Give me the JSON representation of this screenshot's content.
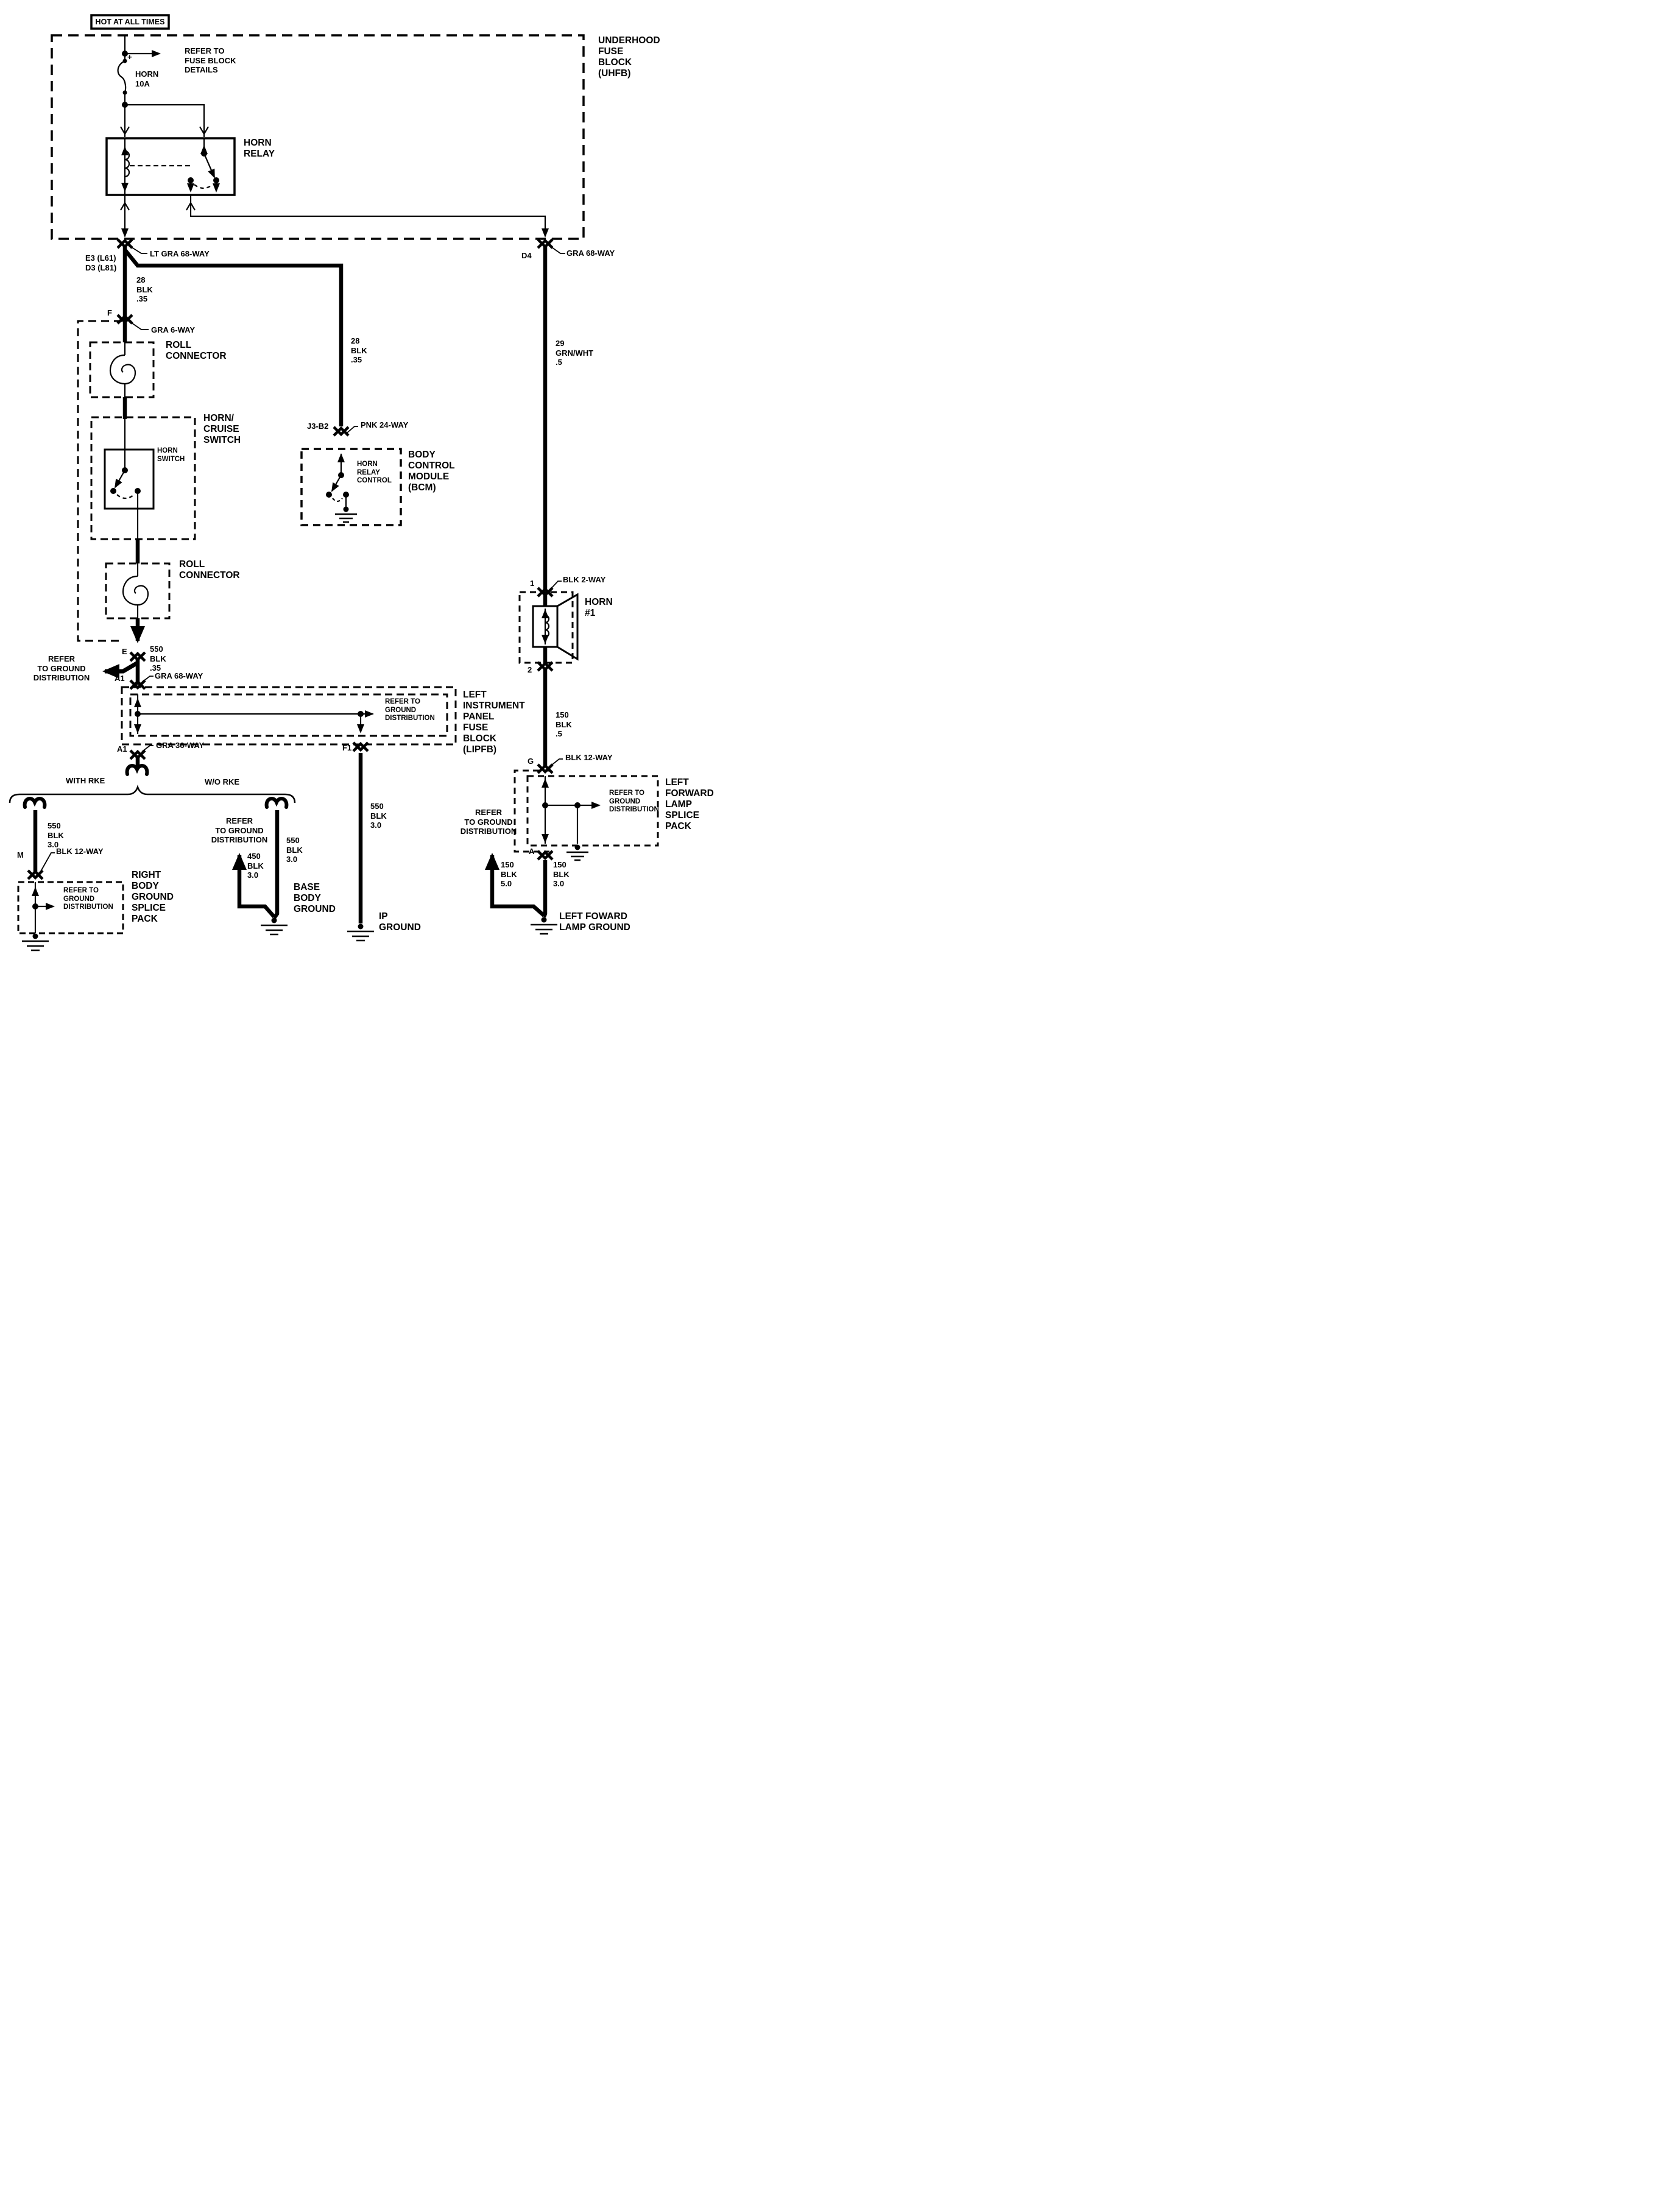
{
  "page": {
    "background": "#ffffff",
    "ink": "#000000"
  },
  "header": {
    "hot_tag": "HOT AT ALL TIMES"
  },
  "uhfb": {
    "refer_fuse": "REFER TO\nFUSE BLOCK\nDETAILS",
    "fuse_plus": "+",
    "fuse_name": "HORN\n10A",
    "title": "UNDERHOOD\nFUSE\nBLOCK\n(UHFB)",
    "relay_name": "HORN\nRELAY",
    "pin_left": "E3 (L61)\nD3 (L81)",
    "conn_left": "LT GRA 68-WAY",
    "pin_right": "D4",
    "conn_right": "GRA 68-WAY"
  },
  "left_run": {
    "wire_top": "28\nBLK\n.35",
    "pin_f": "F",
    "conn_f": "GRA 6-WAY",
    "roll_top": "ROLL\nCONNECTOR",
    "switch_title": "HORN/\nCRUISE\nSWITCH",
    "switch_inner": "HORN\nSWITCH",
    "roll_bottom": "ROLL\nCONNECTOR",
    "refer_ground": "REFER\nTO GROUND\nDISTRIBUTION",
    "pin_e": "E",
    "wire_e": "550\nBLK\n.35",
    "pin_a1": "A1",
    "conn_a1": "GRA 68-WAY"
  },
  "bcm": {
    "pin": "J3-B2",
    "conn": "PNK 24-WAY",
    "wire": "28\nBLK\n.35",
    "control": "HORN\nRELAY\nCONTROL",
    "title": "BODY\nCONTROL\nMODULE\n(BCM)"
  },
  "lipfb": {
    "refer_ground": "REFER TO\nGROUND\nDISTRIBUTION",
    "title": "LEFT\nINSTRUMENT\nPANEL\nFUSE\nBLOCK\n(LIPFB)",
    "pin_a1": "A1",
    "conn_a1": "GRA 36-WAY",
    "pin_f1": "F1"
  },
  "branches": {
    "with_rke": "WITH RKE",
    "without_rke": "W/O RKE"
  },
  "rbgsp": {
    "wire": "550\nBLK\n3.0",
    "pin_m": "M",
    "conn_m": "BLK 12-WAY",
    "refer_ground": "REFER TO\nGROUND\nDISTRIBUTION",
    "title": "RIGHT\nBODY\nGROUND\nSPLICE\nPACK"
  },
  "base_ground": {
    "refer_ground": "REFER\nTO GROUND\nDISTRIBUTION",
    "wire_branch": "450\nBLK\n3.0",
    "wire_main": "550\nBLK\n3.0",
    "title": "BASE\nBODY\nGROUND"
  },
  "ip_ground": {
    "wire": "550\nBLK\n3.0",
    "title": "IP\nGROUND"
  },
  "horn": {
    "wire_top": "29\nGRN/WHT\n.5",
    "pin_1": "1",
    "conn": "BLK 2-WAY",
    "title": "HORN\n#1",
    "pin_2": "2",
    "wire_bottom": "150\nBLK\n.5"
  },
  "lflsp": {
    "pin_g": "G",
    "conn_g": "BLK 12-WAY",
    "refer_ground": "REFER TO\nGROUND\nDISTRIBUTION",
    "title": "LEFT\nFORWARD\nLAMP\nSPLICE\nPACK",
    "refer_ground_left": "REFER\nTO GROUND\nDISTRIBUTION",
    "pin_a": "A",
    "wire_left": "150\nBLK\n5.0",
    "wire_right": "150\nBLK\n3.0",
    "ground_title": "LEFT FOWARD\nLAMP GROUND"
  }
}
